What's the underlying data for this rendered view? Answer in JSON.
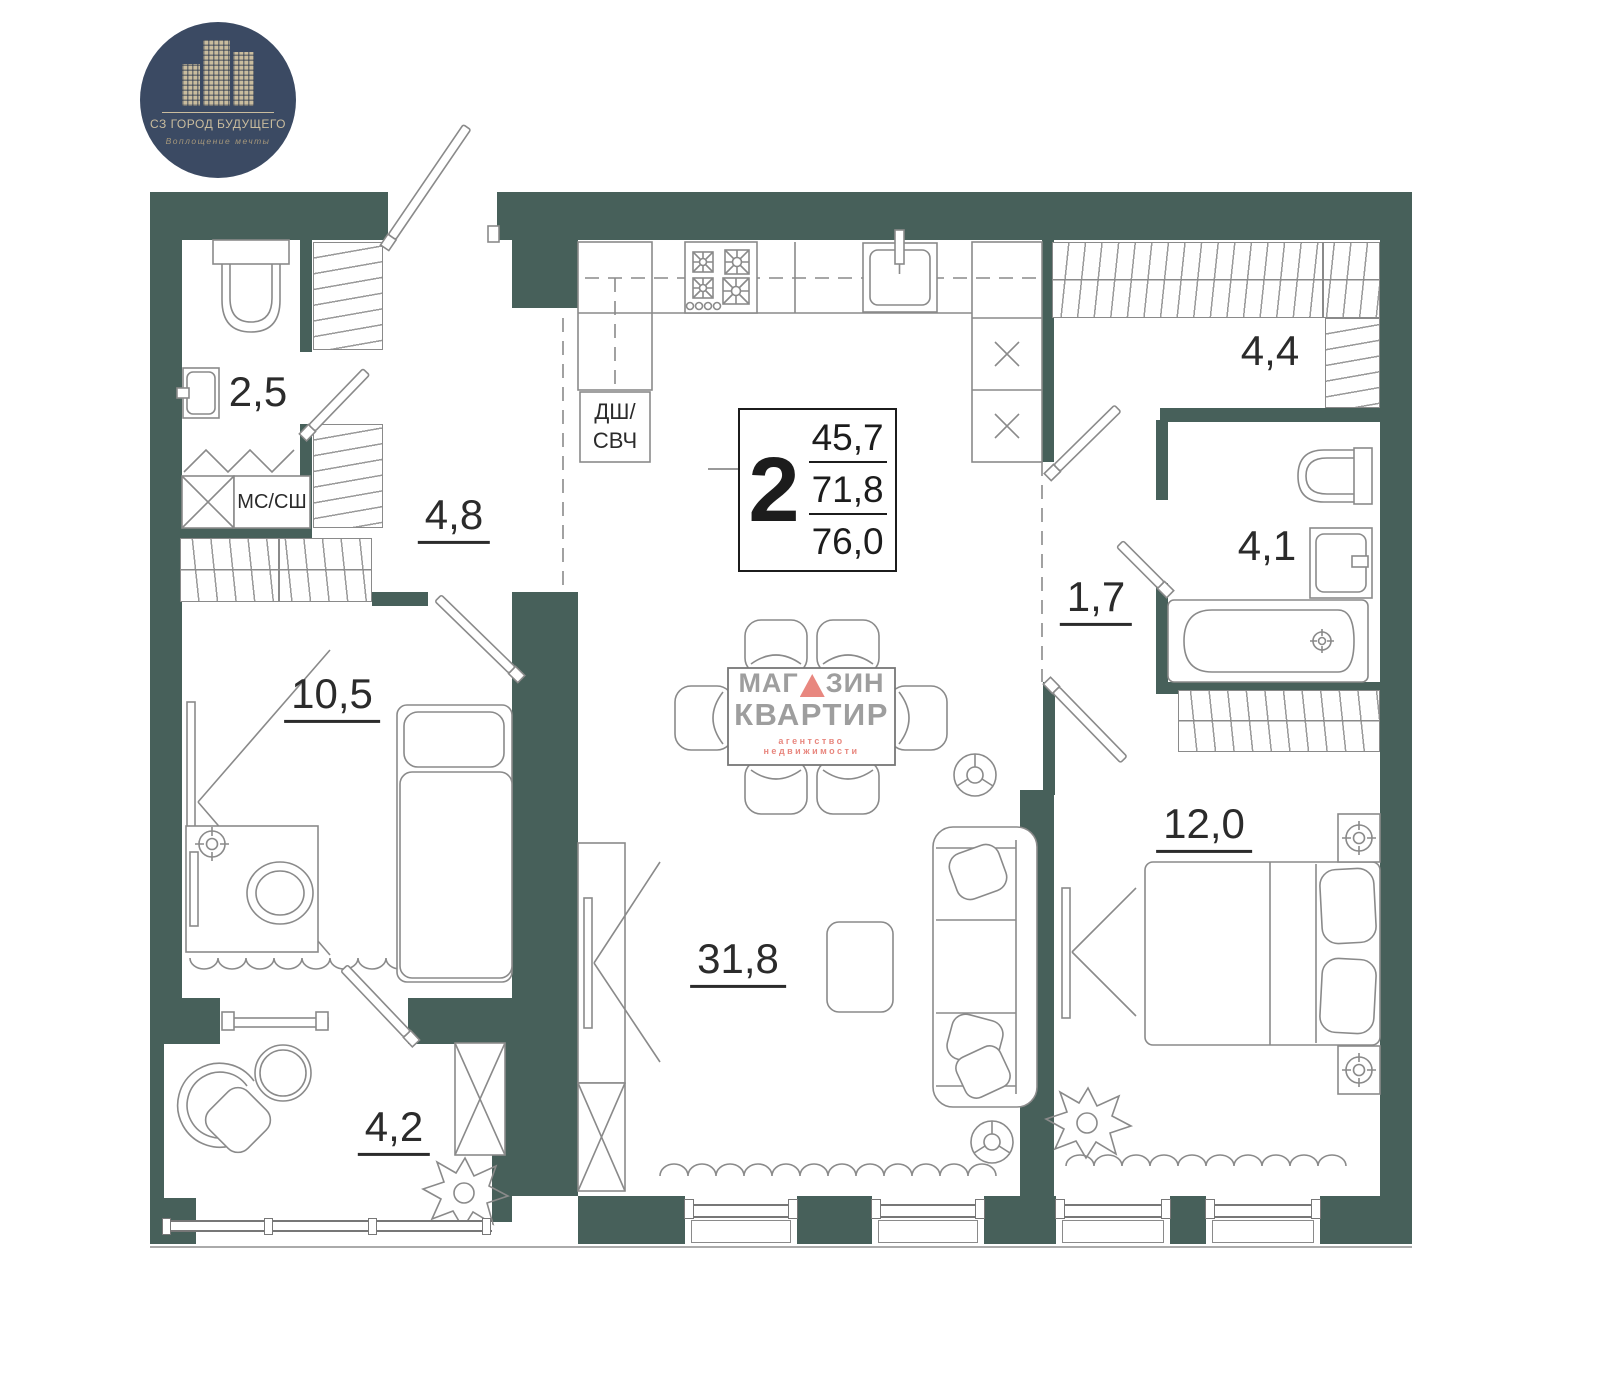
{
  "logo": {
    "name": "СЗ ГОРОД БУДУЩЕГО",
    "tagline": "Воплощение мечты"
  },
  "info_box": {
    "rooms_count": "2",
    "living_area": "45,7",
    "apartment_area": "71,8",
    "total_area": "76,0"
  },
  "watermark": {
    "title_prefix": "МАГ",
    "title_suffix": "ЗИН",
    "title_line2": "КВАРТИР",
    "subtitle": "агентство недвижимости"
  },
  "room_labels": {
    "bathroom_small": "2,5",
    "hallway": "4,8",
    "bedroom_small": "10,5",
    "balcony": "4,2",
    "kitchen_living": "31,8",
    "corridor": "1,7",
    "wardrobe_room": "4,4",
    "bathroom": "4,1",
    "bedroom_main": "12,0"
  },
  "appliance_labels": {
    "washer_dryer": "МС/СШ",
    "dw_mw_line1": "ДШ/",
    "dw_mw_line2": "СВЧ"
  },
  "colors": {
    "wall": "#47605a",
    "line": "#8a8a8a",
    "logo_bg": "#3b4a63",
    "logo_beige": "#c9bc9e",
    "watermark_gray": "#9e9e9e",
    "watermark_red": "#e8877f"
  }
}
